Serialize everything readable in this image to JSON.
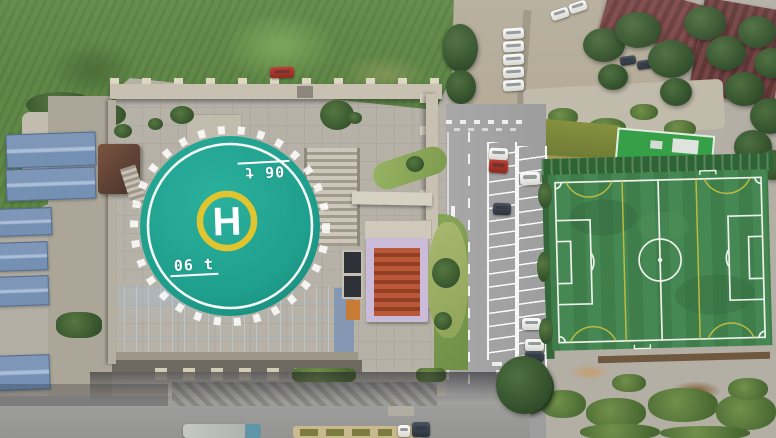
{
  "helipad": {
    "center_letter": "H",
    "weight_marking": "06 t",
    "pad_color": "#1f9f8d",
    "touchdown_ring_color": "#dfc52f",
    "marking_color": "#ffffff"
  },
  "palette": {
    "glass_atrium_roof": "#2e5180",
    "football_pitch_green": "#3f7d4b",
    "pitch_line_white": "#edf1ea",
    "pitch_line_yellow": "#c9c13e",
    "warehouse_roof_blue": "#8ba4c4",
    "meadow_green": "#5f8746",
    "asphalt_gray": "#a3a3a3",
    "bare_soil_brown": "#a5835f",
    "tiled_roof_maroon": "#6e3e3e",
    "sports_hall_green": "#35a047"
  }
}
